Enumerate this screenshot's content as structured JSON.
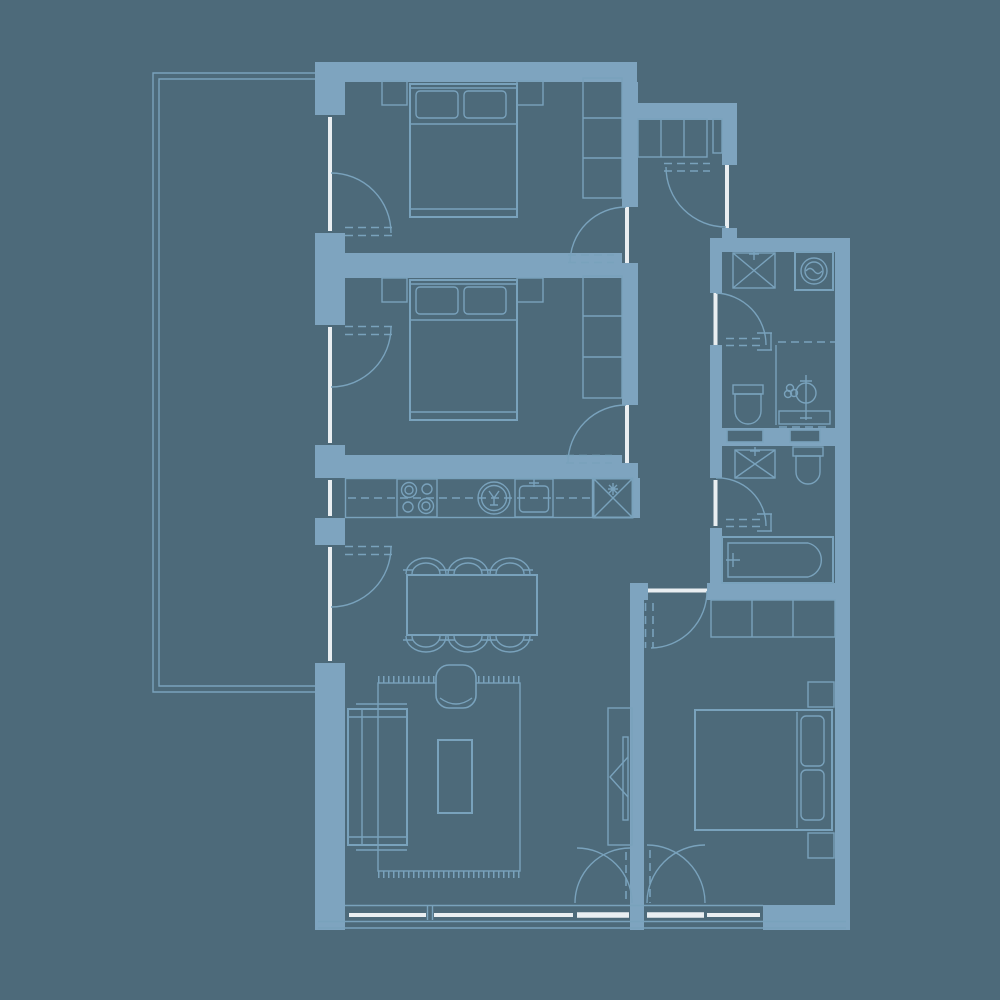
{
  "title": "apartment-floor-plan",
  "colors": {
    "background": "#4d6a7a",
    "wall": "#7ea4bf",
    "line": "#79a2bc",
    "white": "#e9eef1"
  },
  "rooms": [
    {
      "id": "terrace",
      "fixtures": [
        "terrace-outline"
      ]
    },
    {
      "id": "bedroom-1",
      "fixtures": [
        "double-bed-icon",
        "pillow-icon",
        "nightstand-icon",
        "wardrobe-icon",
        "terrace-window-door",
        "hall-door"
      ]
    },
    {
      "id": "bedroom-2",
      "fixtures": [
        "double-bed-icon",
        "pillow-icon",
        "nightstand-icon",
        "wardrobe-icon",
        "terrace-window-door",
        "hall-door"
      ]
    },
    {
      "id": "kitchen",
      "fixtures": [
        "counter",
        "hob-icon",
        "dishwasher-icon",
        "sink-icon",
        "refrigerator-icon",
        "window"
      ]
    },
    {
      "id": "living-dining",
      "fixtures": [
        "dining-table",
        "chair-icon",
        "armchair-icon",
        "rug",
        "sofa-icon",
        "coffee-table",
        "tv-unit-icon",
        "terrace-window-door",
        "balcony-french-door"
      ]
    },
    {
      "id": "hall",
      "fixtures": [
        "entrance-door",
        "closet-shelves",
        "duct"
      ]
    },
    {
      "id": "bathroom-1",
      "fixtures": [
        "vanity-sink-icon",
        "washing-machine-icon",
        "toilet-icon",
        "round-basin-icon",
        "plant-icon",
        "shower-screen"
      ]
    },
    {
      "id": "bathroom-2",
      "fixtures": [
        "vanity-sink-icon",
        "toilet-icon",
        "bathtub-icon"
      ]
    },
    {
      "id": "bedroom-3",
      "fixtures": [
        "wardrobe-icon",
        "double-bed-icon",
        "pillow-icon",
        "nightstand-icon",
        "hall-door",
        "balcony-french-door"
      ]
    }
  ]
}
